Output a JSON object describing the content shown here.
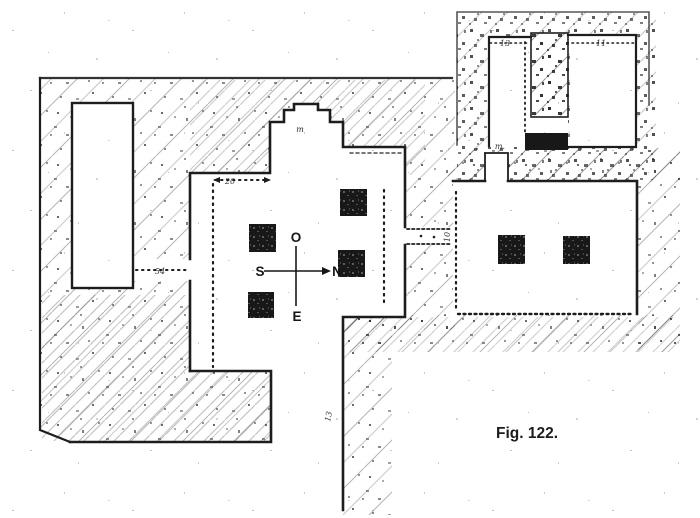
{
  "figure": {
    "caption": "Fig. 122."
  },
  "compass": {
    "top": "O",
    "right": "N",
    "left": "S",
    "bottom": "E"
  },
  "dimension_labels": {
    "north_room_left": "13",
    "north_room_right": "11",
    "west_colonnade": "20",
    "west_corridor": "54",
    "east_corridor": "10",
    "south_corridor": "13",
    "apse": "m",
    "porch": "m."
  },
  "colors": {
    "ink": "#1d1d1d",
    "paper": "#ffffff",
    "hatch": "#3a3a3a"
  }
}
